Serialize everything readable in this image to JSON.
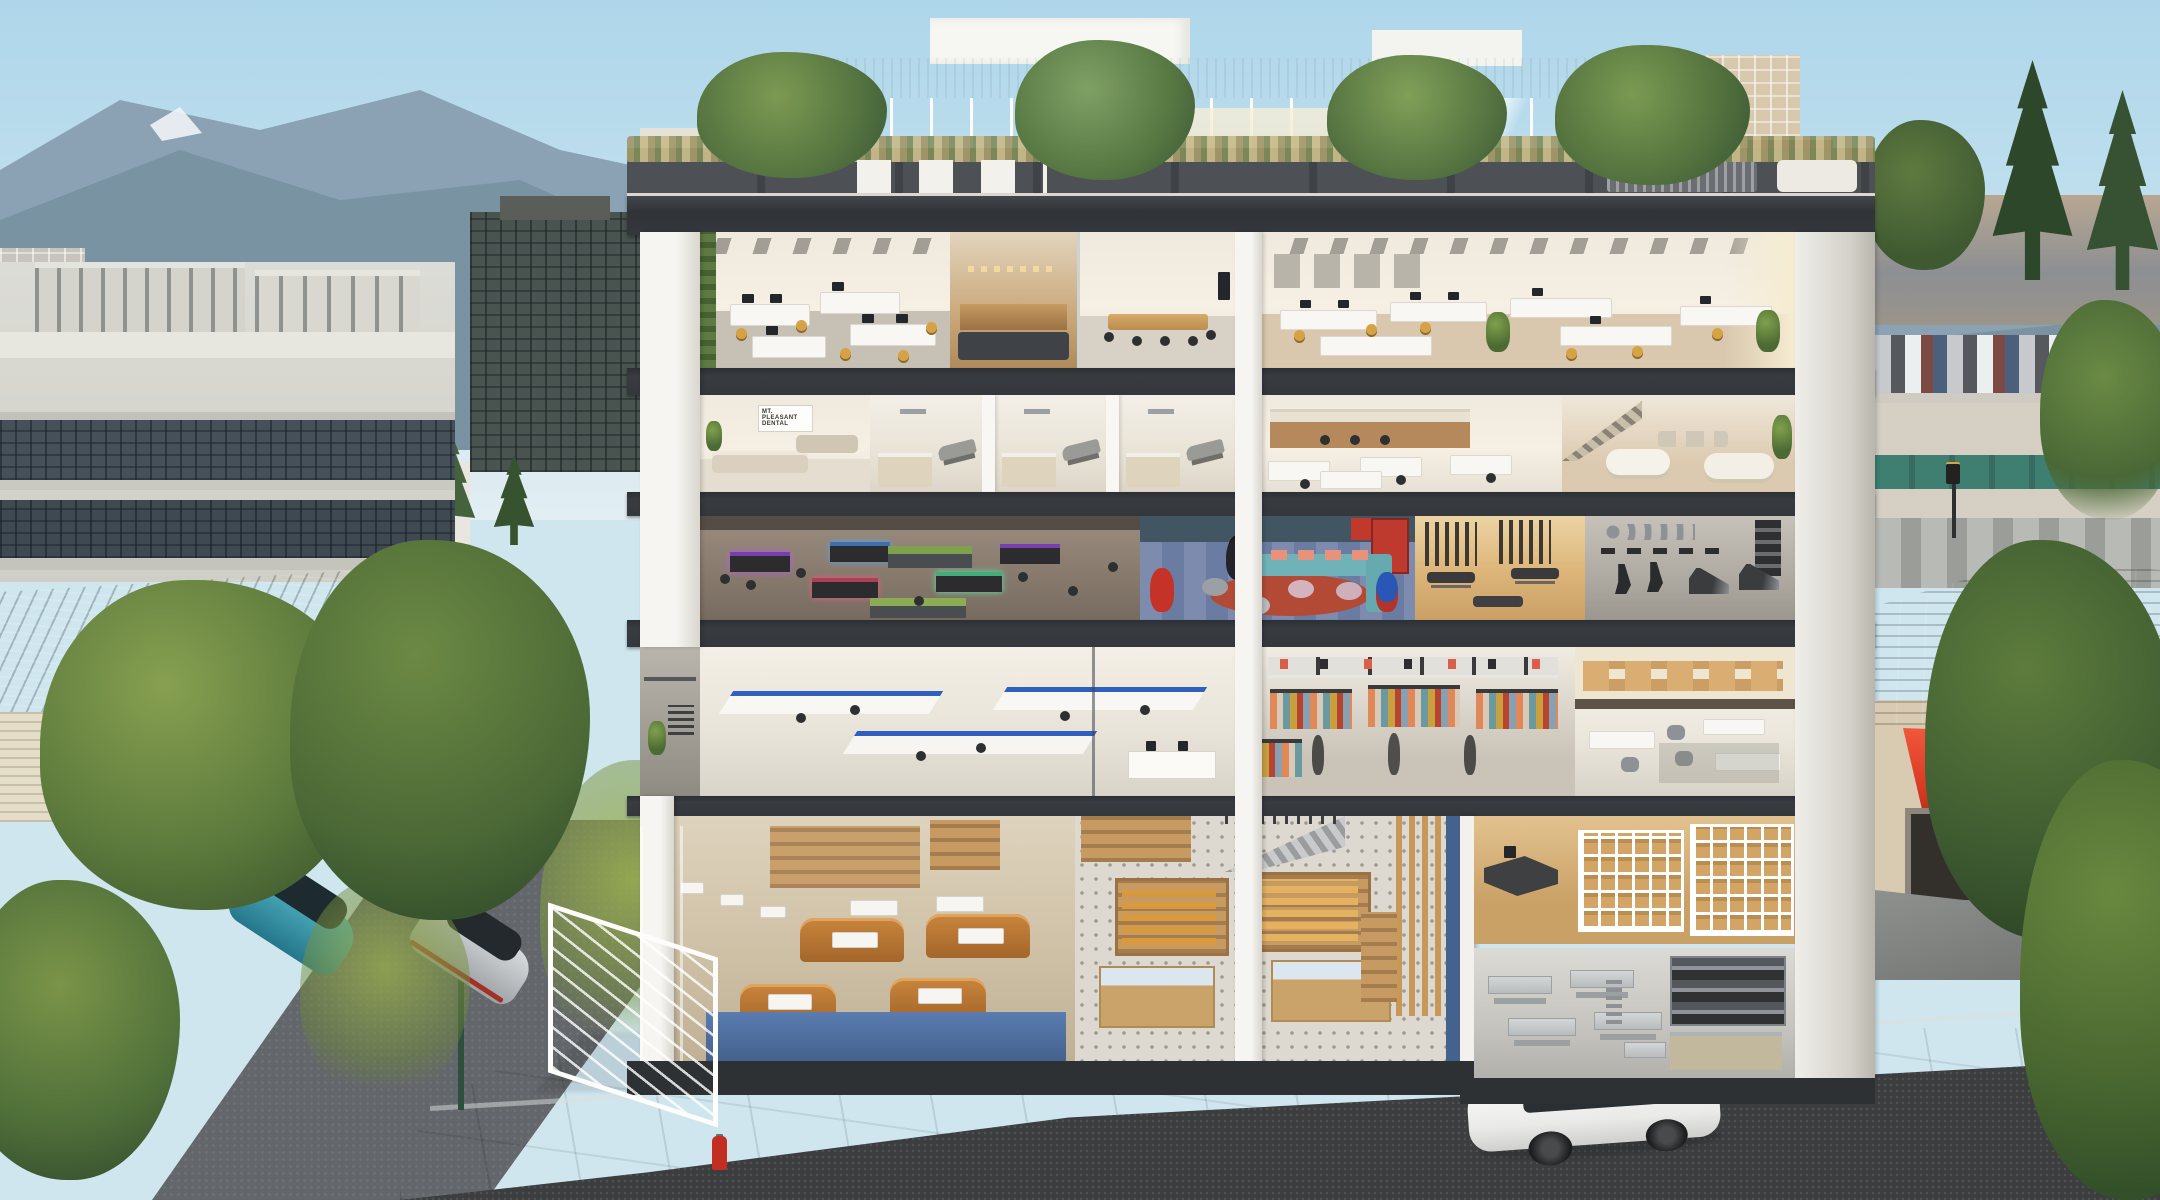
{
  "scene": {
    "type": "architectural cutaway rendering",
    "description": "Sunlit cross-section of a six-level mixed-use corner building revealing furnished interiors on every floor, topped by a landscaped rooftop terrace with a glass pavilion; a mountain-backed city skyline sits behind and parked cars line the streets in front.",
    "time_of_day": "daytime, clear sky"
  },
  "building": {
    "sign": {
      "line1": "MT. PLEASANT",
      "line2": "DENTAL"
    },
    "levels": [
      {
        "label": "Rooftop terrace",
        "units": [
          "glass penthouse pavilion",
          "planter boxes with grasses",
          "terrace trees",
          "outdoor chairs, bench and pink/teal/blue poufs"
        ]
      },
      {
        "label": "Level 5",
        "units": [
          "open-plan office with white desks and mustard task chairs",
          "wood reception lounge with dark sofa",
          "glass meeting room with long wood table",
          "second open-plan office with potted palms and art wall"
        ]
      },
      {
        "label": "Level 4",
        "units": [
          "dental clinic waiting lounge with beige sofas",
          "three dental operatories with recliner chairs",
          "staff office with wood kitchen counter",
          "furniture showroom lounge with white sofas and stair"
        ]
      },
      {
        "label": "Level 3",
        "units": [
          "esports gaming cafe with RGB desks and planters",
          "kids play lounge with teal sofa, salmon cushions, red rug and plush Batman / Flash / Superman",
          "massage studio with wood floor and slat screens",
          "gym with spin bikes, treadmills and ball rack"
        ]
      },
      {
        "label": "Level 2",
        "units": [
          "laboratory clinic with blue-trimmed white counters",
          "corner balcony with potted plant",
          "apparel boutique with multicoloured clothing racks and mannequins",
          "design atelier with mezzanine workshop tables"
        ]
      },
      {
        "label": "Ground",
        "units": [
          "cafe with caramel leather booths on blue bases",
          "gourmet market with timber gondolas on patterned tile",
          "feature stair with timber slat screen",
          "storage mezzanine with kraft-bag shelving and desk",
          "commercial bakery kitchen with stainless tables and deck ovens"
        ]
      }
    ]
  },
  "street": {
    "vehicles": [
      {
        "name": "white SUV with black glass roof",
        "location": "main road, foreground right"
      },
      {
        "name": "teal hatchback",
        "location": "side street, left"
      },
      {
        "name": "silver sedan",
        "location": "side street, left"
      }
    ],
    "objects": [
      "red fire hydrant on sidewalk",
      "green street lamp post",
      "glass entrance canopy on side facade",
      "curved corner sidewalk",
      "young street trees"
    ]
  },
  "surroundings": {
    "left": [
      "white 3-storey concrete office building with rooftop parapets",
      "grey tiled gable warehouse roof",
      "large green street trees"
    ],
    "background": [
      "blue mountain range with snow patches",
      "dark glass office block",
      "green-glass apartment building",
      "brick and white mid-rise blocks",
      "conifer trees"
    ],
    "right": [
      "beige condo tower",
      "houses among conifers",
      "rooftop parking deck full of cars",
      "shops with teal awnings",
      "neighbouring building with red tiled roof and bright red awning",
      "large street trees"
    ]
  },
  "colors": {
    "sky": "#aed6ea",
    "mountain": "#7e96a9",
    "slab": "#34373b",
    "column": "#f6f5f1",
    "interior_wall": "#efe9de",
    "chair_accent": "#d7a245",
    "kids_sofa": "#6fb3b8",
    "kids_cushion": "#e8927c",
    "kids_rug": "#b34a36",
    "lab_trim": "#2f5fc0",
    "booth_leather": "#b5712f",
    "cafe_base": "#4a6ca3",
    "awning_red": "#e8452e",
    "roof_tile": "#9a5a49",
    "asphalt": "#3c3e40",
    "sidewalk": "#a6a9a8"
  }
}
